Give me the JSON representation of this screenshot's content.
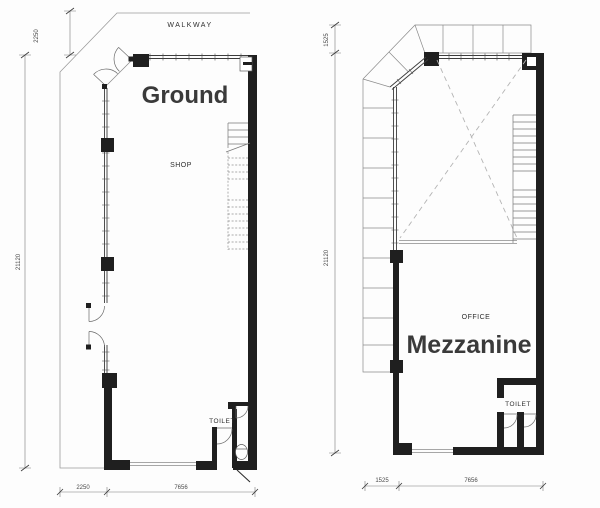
{
  "sheet": {
    "type": "architectural-floor-plans"
  },
  "colors": {
    "ground_title": "#1b7cd8",
    "mezzanine_title": "#3e51c1",
    "wall": "#1f1f1f"
  },
  "plans": {
    "ground": {
      "title": "Ground",
      "walkway_label": "WALKWAY",
      "area_label": "SHOP",
      "toilet_label": "TOILET",
      "dimensions": {
        "side_top": "2250",
        "side_main": "21120",
        "bottom_left": "2250",
        "bottom_right": "7656"
      }
    },
    "mezzanine": {
      "title": "Mezzanine",
      "area_label": "OFFICE",
      "toilet_label": "TOILET",
      "dimensions": {
        "side_top": "1525",
        "side_main": "21120",
        "bottom_left": "1525",
        "bottom_right": "7656"
      }
    }
  }
}
